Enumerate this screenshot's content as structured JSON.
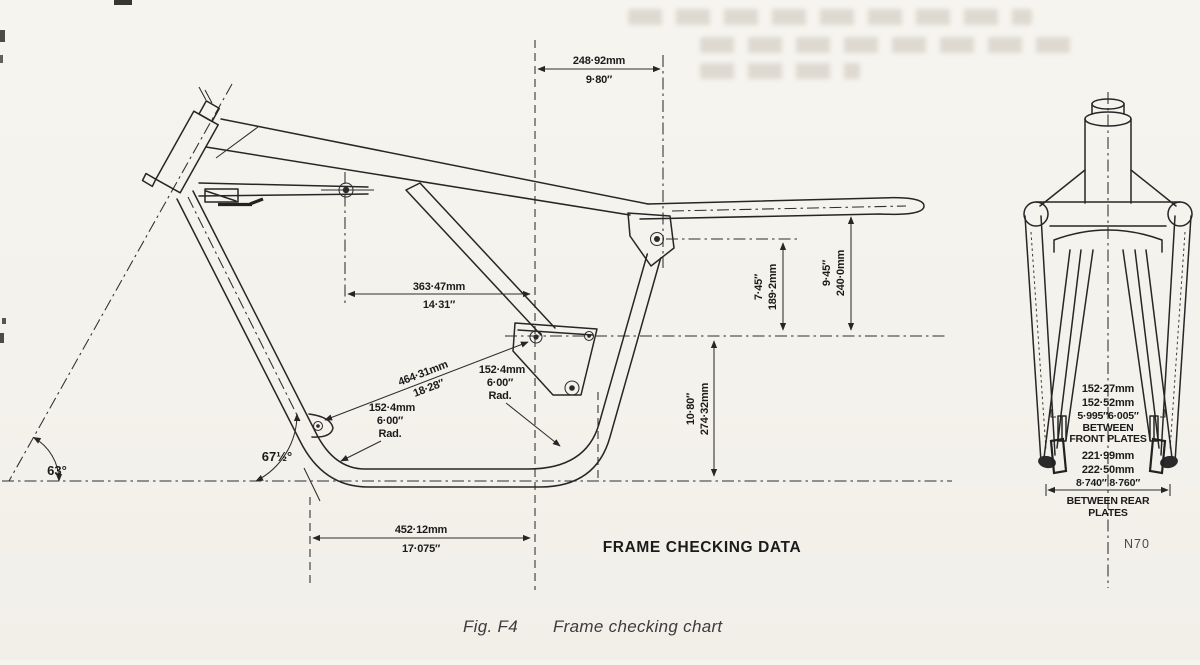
{
  "figure": {
    "heading": "FRAME CHECKING DATA",
    "caption_fig": "Fig. F4",
    "caption_title": "Frame checking chart",
    "page_ref": "N70"
  },
  "side_view": {
    "dim_top": {
      "mm": "248·92mm",
      "in": "9·80″"
    },
    "dim_mid": {
      "mm": "363·47mm",
      "in": "14·31″"
    },
    "dim_bottom": {
      "mm": "452·12mm",
      "in": "17·075″"
    },
    "dim_diagonal": {
      "mm": "464·31mm",
      "in": "18·28″"
    },
    "radius_front": {
      "mm": "152·4mm",
      "in": "6·00″",
      "label": "Rad."
    },
    "radius_rear": {
      "mm": "152·4mm",
      "in": "6·00″",
      "label": "Rad."
    },
    "dim_h745": {
      "in": "7·45″",
      "mm": "189·2mm"
    },
    "dim_h945": {
      "in": "9·45″",
      "mm": "240·0mm"
    },
    "dim_h1080": {
      "in": "10·80″",
      "mm": "274·32mm"
    },
    "angle_steering": "63°",
    "angle_downtube": "67½°"
  },
  "front_view": {
    "front_plates": {
      "mm_min": "152·27mm",
      "mm_max": "152·52mm",
      "in_range": "5·995″6·005″",
      "between": "BETWEEN",
      "label": "FRONT PLATES"
    },
    "rear_plates": {
      "mm_min": "221·99mm",
      "mm_max": "222·50mm",
      "in_range": "8·740″ 8·760″",
      "between": "BETWEEN  REAR",
      "label": "PLATES"
    }
  }
}
